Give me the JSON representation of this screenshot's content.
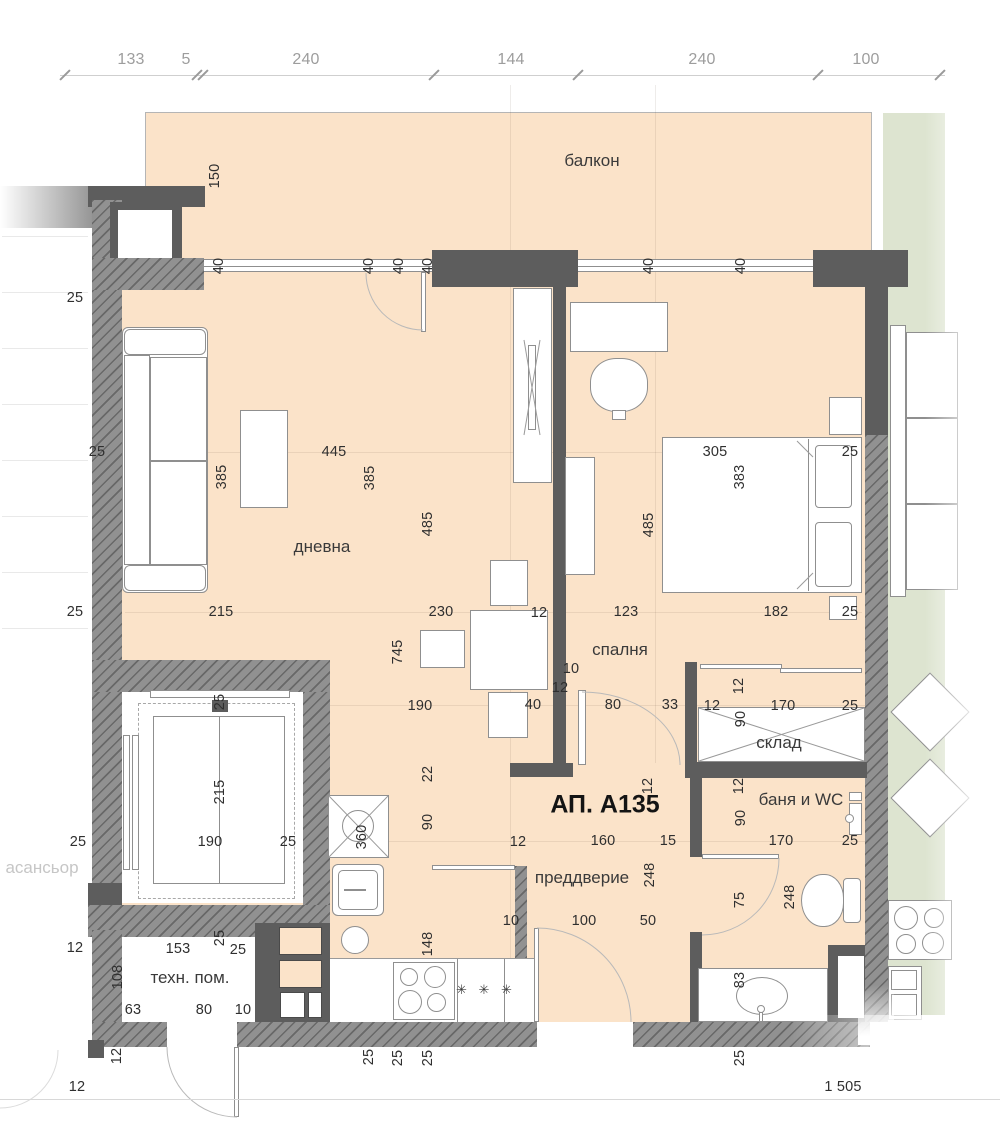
{
  "plan": {
    "apartment_label": "АП. А135",
    "scale_label": "1 505",
    "fridge_symbol": "✳ ✳ ✳",
    "colors": {
      "floor": "#fbe3c9",
      "neighbor_floor": "#dde4d0",
      "wall_solid": "#5d5d5d",
      "wall_hatched": "#919191",
      "dim_text": "#2f2f2f",
      "dim_text_light": "#9d9d9d"
    },
    "rooms": [
      {
        "id": "balcony",
        "label": "балкон",
        "x": 592,
        "y": 161
      },
      {
        "id": "living",
        "label": "дневна",
        "x": 322,
        "y": 547
      },
      {
        "id": "bedroom",
        "label": "спалня",
        "x": 620,
        "y": 650
      },
      {
        "id": "storage",
        "label": "склад",
        "x": 779,
        "y": 743
      },
      {
        "id": "bath",
        "label": "баня и WC",
        "x": 801,
        "y": 800
      },
      {
        "id": "hall",
        "label": "преддверие",
        "x": 582,
        "y": 878
      },
      {
        "id": "tech",
        "label": "техн. пом.",
        "x": 190,
        "y": 978
      },
      {
        "id": "elevator",
        "label": "асансьор",
        "x": 42,
        "y": 868,
        "faded": true
      }
    ],
    "dimensions": [
      {
        "t": "133",
        "x": 131,
        "y": 60,
        "light": 1
      },
      {
        "t": "5",
        "x": 186,
        "y": 60,
        "light": 1
      },
      {
        "t": "240",
        "x": 306,
        "y": 60,
        "light": 1
      },
      {
        "t": "144",
        "x": 511,
        "y": 60,
        "light": 1
      },
      {
        "t": "240",
        "x": 702,
        "y": 60,
        "light": 1
      },
      {
        "t": "100",
        "x": 866,
        "y": 60,
        "light": 1
      },
      {
        "t": "150",
        "x": 215,
        "y": 176,
        "v": 1
      },
      {
        "t": "40",
        "x": 219,
        "y": 266,
        "v": 1
      },
      {
        "t": "40",
        "x": 369,
        "y": 266,
        "v": 1
      },
      {
        "t": "40",
        "x": 399,
        "y": 266,
        "v": 1
      },
      {
        "t": "40",
        "x": 428,
        "y": 266,
        "v": 1
      },
      {
        "t": "40",
        "x": 649,
        "y": 266,
        "v": 1
      },
      {
        "t": "40",
        "x": 741,
        "y": 266,
        "v": 1
      },
      {
        "t": "25",
        "x": 75,
        "y": 298
      },
      {
        "t": "385",
        "x": 222,
        "y": 477,
        "v": 1
      },
      {
        "t": "445",
        "x": 334,
        "y": 452
      },
      {
        "t": "385",
        "x": 370,
        "y": 478,
        "v": 1
      },
      {
        "t": "485",
        "x": 428,
        "y": 524,
        "v": 1
      },
      {
        "t": "305",
        "x": 715,
        "y": 452
      },
      {
        "t": "25",
        "x": 850,
        "y": 452
      },
      {
        "t": "383",
        "x": 740,
        "y": 477,
        "v": 1
      },
      {
        "t": "485",
        "x": 649,
        "y": 525,
        "v": 1
      },
      {
        "t": "25",
        "x": 97,
        "y": 452
      },
      {
        "t": "25",
        "x": 75,
        "y": 612
      },
      {
        "t": "215",
        "x": 221,
        "y": 612
      },
      {
        "t": "230",
        "x": 441,
        "y": 612
      },
      {
        "t": "12",
        "x": 539,
        "y": 613
      },
      {
        "t": "123",
        "x": 626,
        "y": 612
      },
      {
        "t": "182",
        "x": 776,
        "y": 612
      },
      {
        "t": "25",
        "x": 850,
        "y": 612
      },
      {
        "t": "745",
        "x": 398,
        "y": 652,
        "v": 1
      },
      {
        "t": "10",
        "x": 571,
        "y": 669
      },
      {
        "t": "12",
        "x": 560,
        "y": 688
      },
      {
        "t": "190",
        "x": 420,
        "y": 706
      },
      {
        "t": "40",
        "x": 533,
        "y": 705
      },
      {
        "t": "80",
        "x": 613,
        "y": 705
      },
      {
        "t": "33",
        "x": 670,
        "y": 705
      },
      {
        "t": "12",
        "x": 712,
        "y": 706
      },
      {
        "t": "170",
        "x": 783,
        "y": 706
      },
      {
        "t": "25",
        "x": 850,
        "y": 706
      },
      {
        "t": "12",
        "x": 739,
        "y": 686,
        "v": 1
      },
      {
        "t": "90",
        "x": 741,
        "y": 719,
        "v": 1
      },
      {
        "t": "25",
        "x": 220,
        "y": 702,
        "v": 1
      },
      {
        "t": "12",
        "x": 739,
        "y": 786,
        "v": 1
      },
      {
        "t": "90",
        "x": 741,
        "y": 818,
        "v": 1
      },
      {
        "t": "170",
        "x": 781,
        "y": 841
      },
      {
        "t": "25",
        "x": 850,
        "y": 841
      },
      {
        "t": "22",
        "x": 428,
        "y": 774,
        "v": 1
      },
      {
        "t": "90",
        "x": 428,
        "y": 822,
        "v": 1
      },
      {
        "t": "12",
        "x": 518,
        "y": 842
      },
      {
        "t": "160",
        "x": 603,
        "y": 841
      },
      {
        "t": "15",
        "x": 668,
        "y": 841
      },
      {
        "t": "248",
        "x": 650,
        "y": 875,
        "v": 1
      },
      {
        "t": "12",
        "x": 648,
        "y": 786,
        "v": 1
      },
      {
        "t": "215",
        "x": 220,
        "y": 792,
        "v": 1
      },
      {
        "t": "190",
        "x": 210,
        "y": 842
      },
      {
        "t": "25",
        "x": 288,
        "y": 842
      },
      {
        "t": "25",
        "x": 78,
        "y": 842
      },
      {
        "t": "360",
        "x": 362,
        "y": 837,
        "v": 1
      },
      {
        "t": "75",
        "x": 740,
        "y": 900,
        "v": 1
      },
      {
        "t": "248",
        "x": 790,
        "y": 897,
        "v": 1
      },
      {
        "t": "148",
        "x": 428,
        "y": 944,
        "v": 1
      },
      {
        "t": "10",
        "x": 511,
        "y": 921
      },
      {
        "t": "100",
        "x": 584,
        "y": 921
      },
      {
        "t": "50",
        "x": 648,
        "y": 921
      },
      {
        "t": "83",
        "x": 740,
        "y": 980,
        "v": 1
      },
      {
        "t": "12",
        "x": 75,
        "y": 948
      },
      {
        "t": "153",
        "x": 178,
        "y": 949
      },
      {
        "t": "25",
        "x": 220,
        "y": 938,
        "v": 1
      },
      {
        "t": "25",
        "x": 238,
        "y": 950
      },
      {
        "t": "108",
        "x": 118,
        "y": 977,
        "v": 1
      },
      {
        "t": "63",
        "x": 133,
        "y": 1010
      },
      {
        "t": "80",
        "x": 204,
        "y": 1010
      },
      {
        "t": "10",
        "x": 243,
        "y": 1010
      },
      {
        "t": "12",
        "x": 117,
        "y": 1056,
        "v": 1
      },
      {
        "t": "25",
        "x": 369,
        "y": 1057,
        "v": 1
      },
      {
        "t": "25",
        "x": 398,
        "y": 1058,
        "v": 1
      },
      {
        "t": "25",
        "x": 428,
        "y": 1058,
        "v": 1
      },
      {
        "t": "25",
        "x": 740,
        "y": 1058,
        "v": 1
      },
      {
        "t": "12",
        "x": 77,
        "y": 1087
      },
      {
        "t": "1 505",
        "x": 843,
        "y": 1087
      }
    ]
  }
}
